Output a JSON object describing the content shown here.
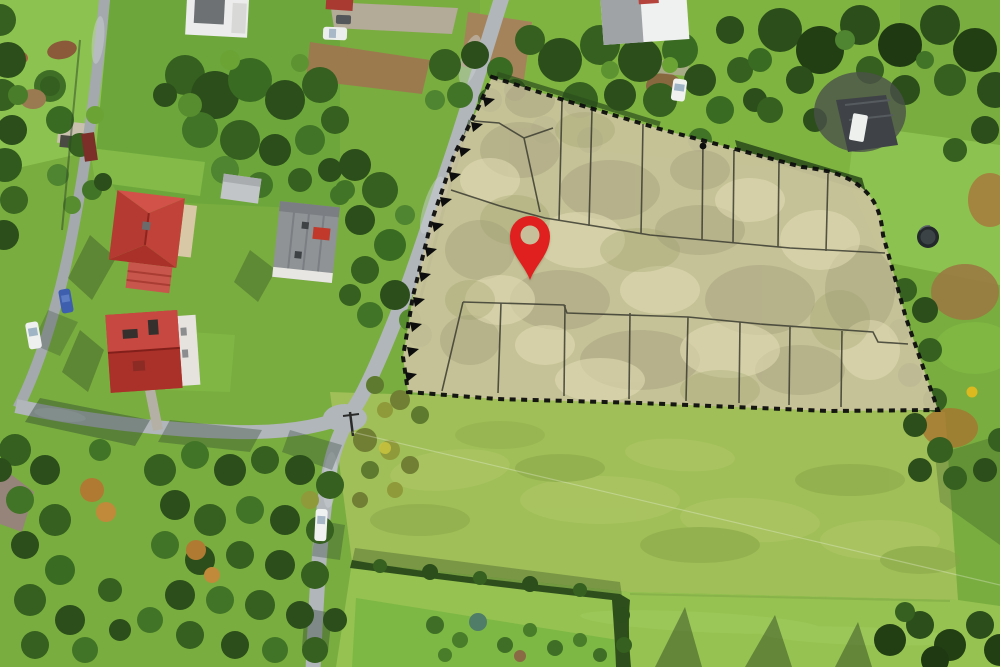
{
  "scene": {
    "marker": {
      "icon": "location-pin-icon",
      "x": 506,
      "y": 210,
      "width": 48,
      "height": 72
    }
  },
  "plot": {
    "top_row_parcels": 8,
    "bottom_row_parcels": 8
  },
  "colors": {
    "pin_red": "#e01f1f",
    "pin_hole": "#c6bf99",
    "plot_fill": "#cbc39d",
    "plot_fill_dark": "#a8a280",
    "plot_fill_light": "#e4ddb7",
    "plot_fill_green": "#9aa06b",
    "boundary": "#0d0d0d",
    "parcel_line": "#3c3c32",
    "grass_base": "#79ad3f",
    "lawn_bright": "#8cc24f",
    "meadow": "#a0bf58",
    "mowed_lawn": "#95c251",
    "road": "#b0b6b9",
    "road_dark": "#a3a9ad",
    "tree_dark": "#2b4e1a",
    "tree_deep": "#223f14",
    "tree_mid": "#3a6b22",
    "tree_light": "#578c2f",
    "roof_red": "#bc3f38",
    "roof_red_light": "#d05048",
    "roof_gray": "#8f9396",
    "soil": "#9b7a4e",
    "gravel": "#b3aa97",
    "autumn": "#b07a33"
  }
}
